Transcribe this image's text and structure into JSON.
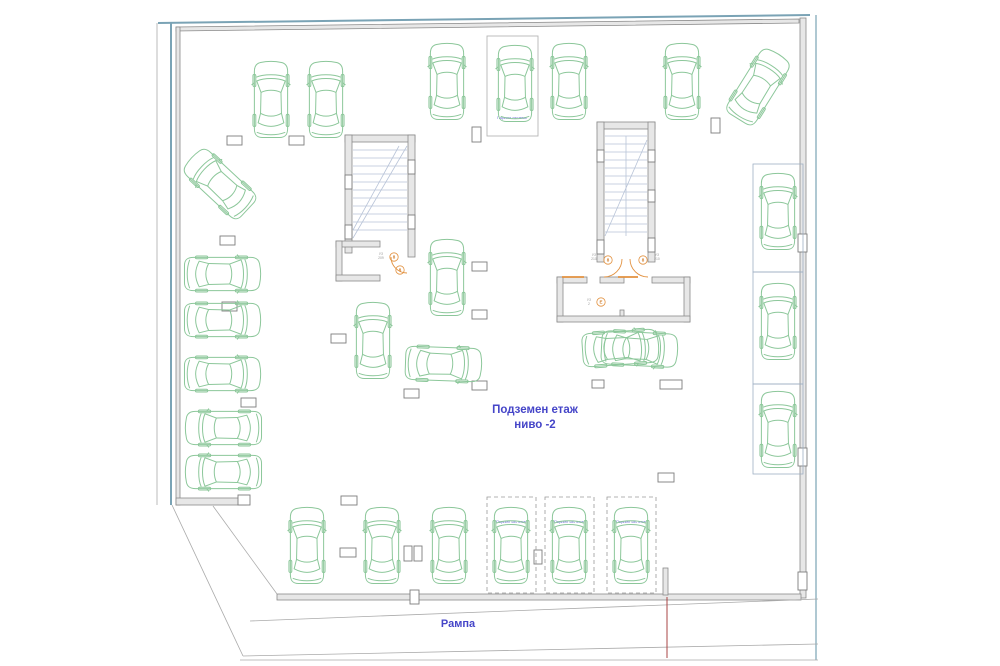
{
  "labels": {
    "level_line1": "Подземен етаж",
    "level_line2": "ниво -2",
    "ramp": "Рампа",
    "parking_system": "Паркинг система"
  },
  "colors": {
    "car_outline": "#8cc79a",
    "boundary_blue": "#7aa3b5",
    "wall_gray": "#8a8a8a",
    "label_blue": "#4545c8",
    "door_orange": "#e2913f",
    "ramp_red_line": "#a84444"
  },
  "cars": [
    {
      "x": 252,
      "y": 60
    },
    {
      "x": 307,
      "y": 60
    },
    {
      "x": 428,
      "y": 40,
      "h": 84
    },
    {
      "x": 496,
      "y": 42,
      "h": 84
    },
    {
      "x": 550,
      "y": 40,
      "h": 84
    },
    {
      "x": 663,
      "y": 40,
      "h": 84
    },
    {
      "x": 739,
      "y": 46,
      "r": 32,
      "h": 82
    },
    {
      "x": 201,
      "y": 143,
      "r": -47,
      "h": 82
    },
    {
      "x": 203,
      "y": 234,
      "r": 90
    },
    {
      "x": 203,
      "y": 280,
      "r": 90
    },
    {
      "x": 203,
      "y": 334,
      "r": 90
    },
    {
      "x": 205,
      "y": 388,
      "r": -90
    },
    {
      "x": 205,
      "y": 432,
      "r": -90
    },
    {
      "x": 428,
      "y": 237,
      "h": 82
    },
    {
      "x": 354,
      "y": 300,
      "h": 82
    },
    {
      "x": 424,
      "y": 324,
      "r": 92
    },
    {
      "x": 601,
      "y": 308,
      "r": 86
    },
    {
      "x": 620,
      "y": 309,
      "r": 93
    },
    {
      "x": 759,
      "y": 172
    },
    {
      "x": 759,
      "y": 282
    },
    {
      "x": 759,
      "y": 390
    },
    {
      "x": 288,
      "y": 506
    },
    {
      "x": 363,
      "y": 506
    },
    {
      "x": 430,
      "y": 506
    },
    {
      "x": 492,
      "y": 504,
      "h": 84
    },
    {
      "x": 550,
      "y": 504,
      "h": 84
    },
    {
      "x": 612,
      "y": 504,
      "h": 84
    }
  ],
  "parking_boxes": [
    {
      "x": 487,
      "y": 36,
      "w": 51,
      "h": 100,
      "style": "solid",
      "lx": 512,
      "ly": 119,
      "labeled": true
    },
    {
      "x": 753,
      "y": 164,
      "w": 50,
      "h": 108,
      "style": "outline",
      "labeled": false
    },
    {
      "x": 753,
      "y": 272,
      "w": 50,
      "h": 112,
      "style": "outline",
      "labeled": false
    },
    {
      "x": 753,
      "y": 384,
      "w": 50,
      "h": 90,
      "style": "outline",
      "labeled": false
    },
    {
      "x": 487,
      "y": 497,
      "w": 49,
      "h": 96,
      "style": "dashed",
      "lx": 511,
      "ly": 523,
      "labeled": true
    },
    {
      "x": 545,
      "y": 497,
      "w": 49,
      "h": 96,
      "style": "dashed",
      "lx": 569,
      "ly": 523,
      "labeled": true
    },
    {
      "x": 607,
      "y": 497,
      "w": 49,
      "h": 96,
      "style": "dashed",
      "lx": 631,
      "ly": 523,
      "labeled": true
    }
  ],
  "door_tags": [
    {
      "x": 394,
      "y": 257,
      "t": "8"
    },
    {
      "x": 400,
      "y": 270,
      "t": "8"
    },
    {
      "x": 608,
      "y": 260,
      "t": "8"
    },
    {
      "x": 643,
      "y": 260,
      "t": "8"
    },
    {
      "x": 601,
      "y": 302,
      "t": "Е"
    }
  ],
  "door_labels": [
    {
      "x": 381,
      "y": 255,
      "l1": "УЗ",
      "l2": "209"
    },
    {
      "x": 594,
      "y": 256,
      "l1": "УЗ",
      "l2": "210"
    },
    {
      "x": 657,
      "y": 256,
      "l1": "УЗ",
      "l2": "210"
    },
    {
      "x": 589,
      "y": 301,
      "l1": "УЗ",
      "l2": "2"
    }
  ]
}
